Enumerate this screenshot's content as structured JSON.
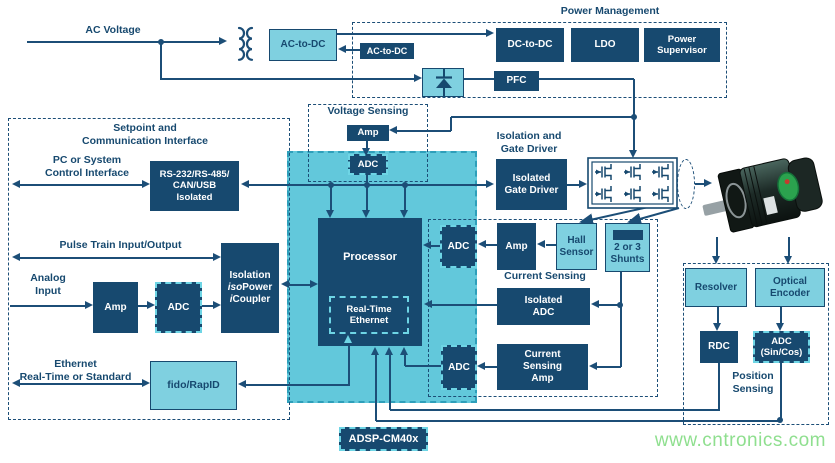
{
  "diagram": {
    "watermark": "www.cntronics.com",
    "labels": {
      "ac_voltage": "AC Voltage",
      "power_management": "Power Management",
      "voltage_sensing": "Voltage Sensing",
      "setpoint": "Setpoint and\nCommunication Interface",
      "pc_control": "PC or System\nControl Interface",
      "pulse_train": "Pulse Train Input/Output",
      "analog_input": "Analog\nInput",
      "ethernet": "Ethernet\nReal-Time or Standard",
      "isolation_gate": "Isolation and\nGate Driver",
      "current_sensing": "Current Sensing",
      "position_sensing": "Position\nSensing"
    },
    "blocks": {
      "ac_to_dc_main": "AC-to-DC",
      "ac_to_dc_ctrl": "AC-to-DC",
      "dc_to_dc": "DC-to-DC",
      "ldo": "LDO",
      "power_supervisor": "Power\nSupervisor",
      "pfc": "PFC",
      "vs_amp": "Amp",
      "vs_adc": "ADC",
      "rs232": "RS-232/RS-485/\nCAN/USB\nIsolated",
      "isolation": {
        "l1": "Isolation",
        "l2a": "iso",
        "l2b": "Power",
        "l3a": "i",
        "l3b": "Coupler"
      },
      "an_amp": "Amp",
      "an_adc": "ADC",
      "fido": "fido/RapID",
      "processor": "Processor",
      "rt_ethernet": "Real-Time\nEthernet",
      "isolated_gate_driver": "Isolated\nGate Driver",
      "cs_amp_small": "Amp",
      "hall": "Hall\nSensor",
      "shunts": "2 or 3\nShunts",
      "adc_hall": "ADC",
      "isolated_adc": "Isolated\nADC",
      "current_sensing_amp": "Current\nSensing\nAmp",
      "adc_cs": "ADC",
      "resolver": "Resolver",
      "optical_encoder": "Optical\nEncoder",
      "rdc": "RDC",
      "adc_sincos": "ADC\n(Sin/Cos)",
      "adsp": "ADSP-CM40x"
    },
    "colors": {
      "navy": "#17496f",
      "line": "#1c4e77",
      "light_blue": "#7fd0e0",
      "chip_cyan": "#62c8db",
      "dashed_cyan": "#6ed5e5",
      "watermark_green": "#8fdf8f"
    }
  }
}
